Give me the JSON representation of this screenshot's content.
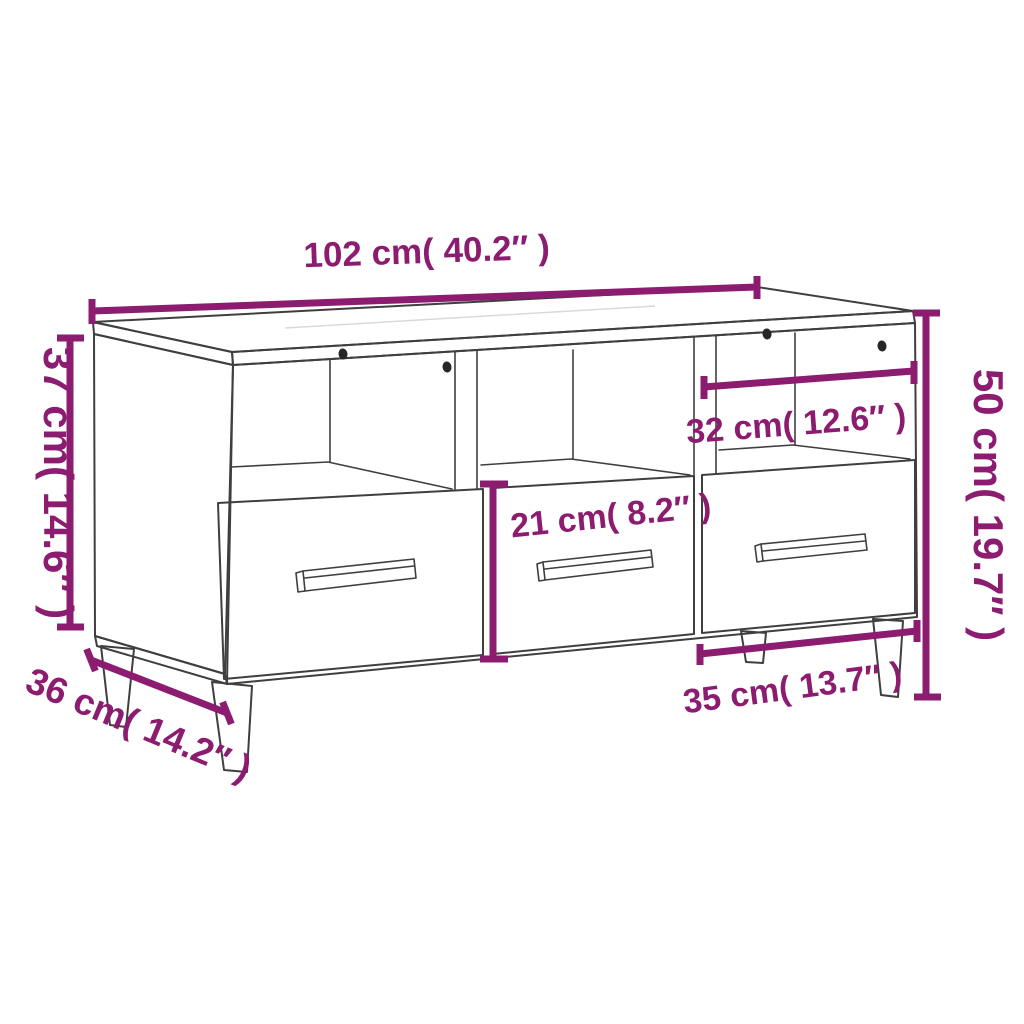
{
  "figure": {
    "type": "product-dimension-diagram",
    "subject": "tv-cabinet-with-3-open-shelves-and-3-drawers",
    "colors": {
      "accent": "#8C1C70",
      "line": "#3F3F3F",
      "background": "#FFFFFF",
      "hole": "#262626"
    },
    "labels": {
      "width_top": "102 cm( 40.2″ )",
      "height_left": "37 cm( 14.6″ )",
      "height_right": "50 cm( 19.7″ )",
      "shelf_width": "32 cm( 12.6″ )",
      "drawer_height": "21 cm( 8.2″ )",
      "depth": "36 cm( 14.2″ )",
      "drawer_width": "35 cm( 13.7″ )"
    }
  }
}
